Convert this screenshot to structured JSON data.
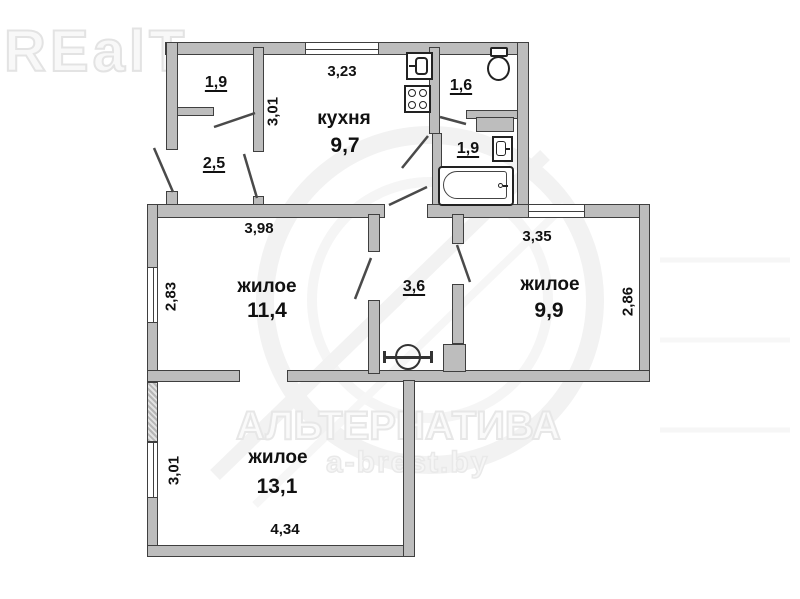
{
  "watermarks": {
    "logo": "REalT",
    "brand": "АЛЬТЕРНАТИВА",
    "site": "a-brest.by"
  },
  "rooms": {
    "kitchen": {
      "name": "кухня",
      "area": "9,7"
    },
    "living_left": {
      "name": "жилое",
      "area": "11,4"
    },
    "living_right": {
      "name": "жилое",
      "area": "9,9"
    },
    "living_bottom": {
      "name": "жилое",
      "area": "13,1"
    },
    "closet": {
      "area": "1,9"
    },
    "hallway": {
      "area": "2,5"
    },
    "wc": {
      "area": "1,6"
    },
    "bathroom": {
      "area": "1,9"
    },
    "corridor": {
      "area": "3,6"
    }
  },
  "dimensions": {
    "kitchen_width": "3,23",
    "kitchen_depth": "3,01",
    "living_left_width": "3,98",
    "living_left_depth": "2,83",
    "living_right_width": "3,35",
    "living_right_depth": "2,86",
    "living_bottom_depth": "3,01",
    "living_bottom_width": "4,34"
  },
  "fixtures": [
    "sink-icon",
    "stove-icon",
    "toilet-icon",
    "washbasin-icon",
    "bathtub-icon",
    "basin-symbol-icon"
  ],
  "colors": {
    "wall_fill": "#bdbdbd",
    "wall_edge": "#3f3f3f",
    "label_text": "#111111",
    "watermark": "#e6e6e6"
  }
}
